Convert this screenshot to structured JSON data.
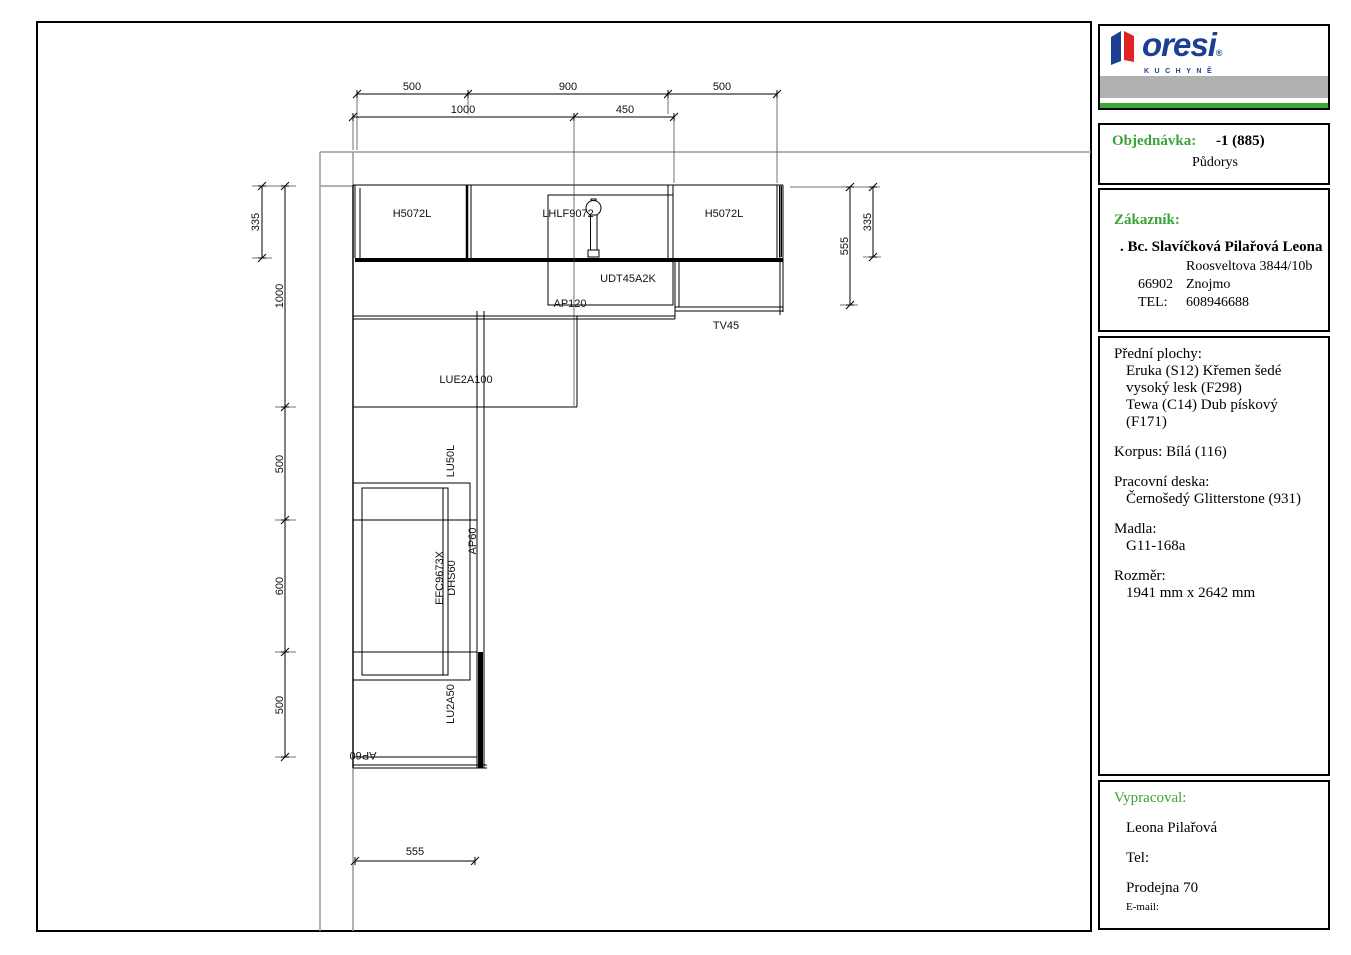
{
  "logo": {
    "brand": "oresi",
    "registered": "®",
    "subbrand": "KUCHYNĚ"
  },
  "title_block": {
    "order_label": "Objednávka:",
    "order_value": "-1 (885)",
    "view_name": "Půdorys",
    "customer_label": "Zákazník:",
    "customer_name": ". Bc. Slavíčková Pilařová Leona",
    "customer_street": "Roosveltova 3844/10b",
    "customer_zip": "66902",
    "customer_city": "Znojmo",
    "phone_label": "TEL:",
    "phone_value": "608946688",
    "fronts_label": "Přední plochy:",
    "front_1": "Eruka (S12) Křemen šedé vysoký lesk (F298)",
    "front_2": "Tewa (C14) Dub pískový (F171)",
    "korpus_label": "Korpus:",
    "korpus_value": "Bílá (116)",
    "worktop_label": "Pracovní deska:",
    "worktop_value": "Černošedý Glitterstone (931)",
    "handles_label": "Madla:",
    "handles_value": "G11-168a",
    "size_label": "Rozměr:",
    "size_value": "1941 mm x 2642 mm",
    "author_label": "Vypracoval:",
    "author_name": "Leona Pilařová",
    "author_tel_label": "Tel:",
    "author_store": "Prodejna 70",
    "author_email_label": "E-mail:"
  },
  "plan": {
    "labels": {
      "wall_cab_left": "H5072L",
      "wall_cab_mid": "LHLF9072",
      "wall_cab_right": "H5072L",
      "tall_cab": "UDT45A2K",
      "worktop_ap120": "AP120",
      "worktop_tv45": "TV45",
      "corner_cab": "LUE2A100",
      "base_cab_lu50l": "LU50L",
      "hood": "EFC9673X",
      "hob": "DHS60",
      "worktop_ap60_side": "AP60",
      "base_cab_lu2a50": "LU2A50",
      "worktop_ap60_bottom": "AP60"
    },
    "dims": {
      "top_row1": [
        "500",
        "900",
        "500"
      ],
      "top_row2": [
        "1000",
        "450"
      ],
      "left_inner_335": "335",
      "left_outer": [
        "1000",
        "500",
        "600",
        "500"
      ],
      "right_555": "555",
      "right_335": "335",
      "bottom_555": "555"
    }
  },
  "colors": {
    "accent_green": "#3aa437",
    "logo_blue": "#1c3f94",
    "logo_red": "#e02421",
    "bar_gray": "#b1b1b1",
    "bar_green": "#3aaa35",
    "wall_gray": "#999999"
  }
}
